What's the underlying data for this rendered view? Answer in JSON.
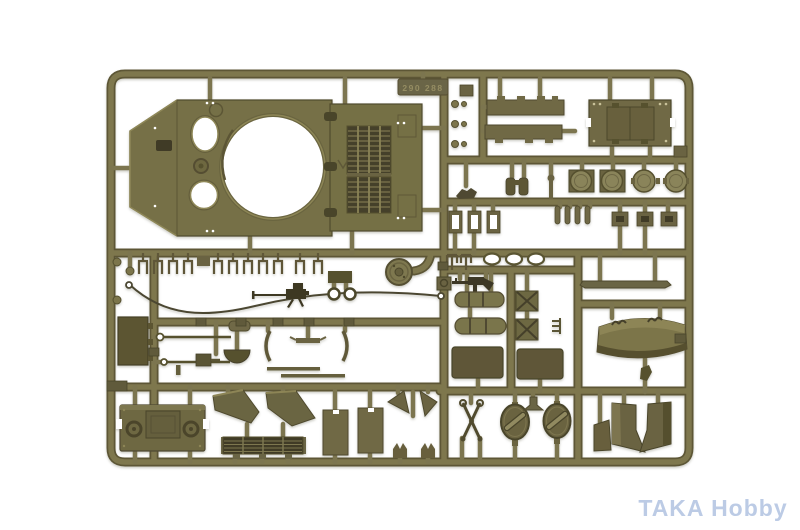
{
  "photo": {
    "subject": "Olive drab injection-molded model tank sprue on white background",
    "background_color": "#ffffff",
    "plastic_color": "#7b744c",
    "plastic_dark": "#554f30",
    "plastic_light": "#8d8659"
  },
  "sprue": {
    "embossed_tag": "290 288",
    "part_groups": [
      "upper hull with turret ring opening",
      "engine deck grilles",
      "hull sponson strips",
      "riveted hatch plate",
      "round hatch covers",
      "idler wheel",
      "tow cable wire",
      "machine gun",
      "submachine gun",
      "bed rolls",
      "x-braced stowage boxes",
      "access panels",
      "curved engine deck cover",
      "rear hull plate",
      "mudguards",
      "louvered grille",
      "fuel tank panels",
      "oval hatches with handles",
      "final drive wedges",
      "tow cable clamp",
      "small brackets and pegs"
    ]
  },
  "watermark": {
    "text": "TAKA Hobby",
    "color": "#b5c6e3"
  }
}
